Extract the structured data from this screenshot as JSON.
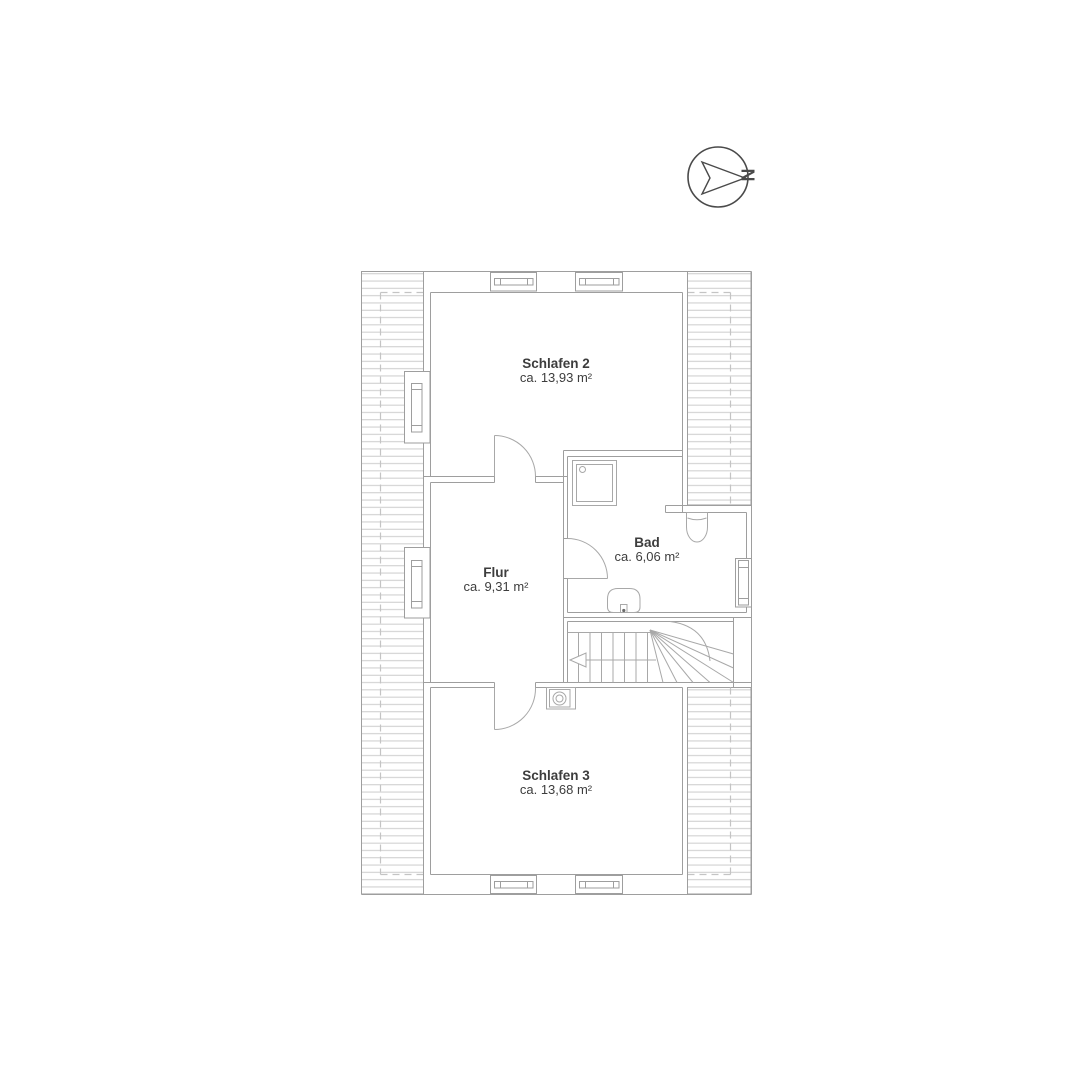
{
  "compass": {
    "north_label": "N"
  },
  "floor_plan": {
    "rooms": [
      {
        "id": "schlafen-2",
        "name": "Schlafen 2",
        "area": "ca. 13,93 m²"
      },
      {
        "id": "bad",
        "name": "Bad",
        "area": "ca. 6,06 m²"
      },
      {
        "id": "flur",
        "name": "Flur",
        "area": "ca. 9,31 m²"
      },
      {
        "id": "schlafen-3",
        "name": "Schlafen 3",
        "area": "ca. 13,68 m²"
      }
    ],
    "fixture_icons": [
      "stairs-icon",
      "shower-icon",
      "toilet-icon",
      "sink-icon",
      "chimney-icon",
      "window-icon",
      "door-swing-icon",
      "north-arrow-icon",
      "roof-slope-hatch"
    ]
  },
  "colors": {
    "background": "#ffffff",
    "wall_line": "#9e9e9e",
    "hatch_line": "#cccccc",
    "dashed_line": "#c4c4c4",
    "fixture_line": "#a8a8a8",
    "compass_line": "#4a4a4a",
    "text": "#3d3d3d"
  }
}
